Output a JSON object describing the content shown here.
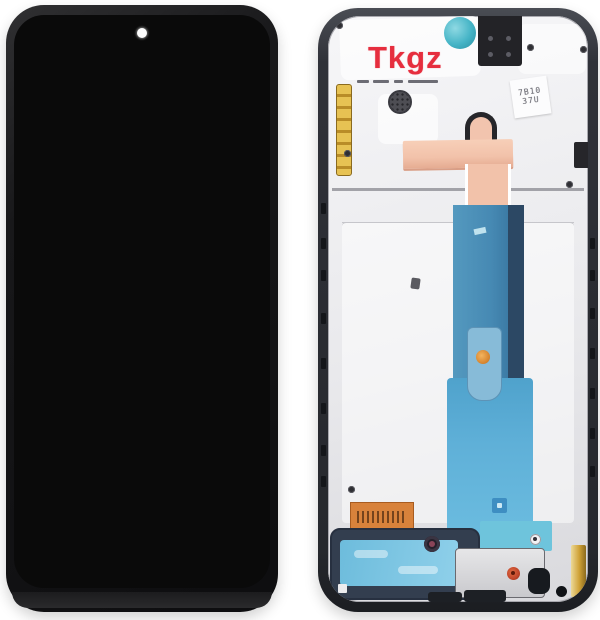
{
  "watermark": {
    "text": "Tkgz"
  },
  "stickers": {
    "qr_code_line1": "7B10",
    "qr_code_line2": "37U"
  },
  "colors": {
    "canvas_bg": "#ffffff",
    "screen_black": "#0a0a0a",
    "plate_light": "#e9e9ec",
    "teal": "#45b4c6",
    "copper_flex": "#f2c2aa",
    "blue_flex": "#4689b3",
    "navy_flex": "#2c4864",
    "lightblue_flex": "#5fb0d8",
    "mesh_cyan": "#7ec6e3",
    "speaker_navy": "#333e4f",
    "gold": "#cfa136",
    "sticker_orange": "#d8823b",
    "screw_red": "#c0452a",
    "watermark_red": "#e62e3e"
  }
}
